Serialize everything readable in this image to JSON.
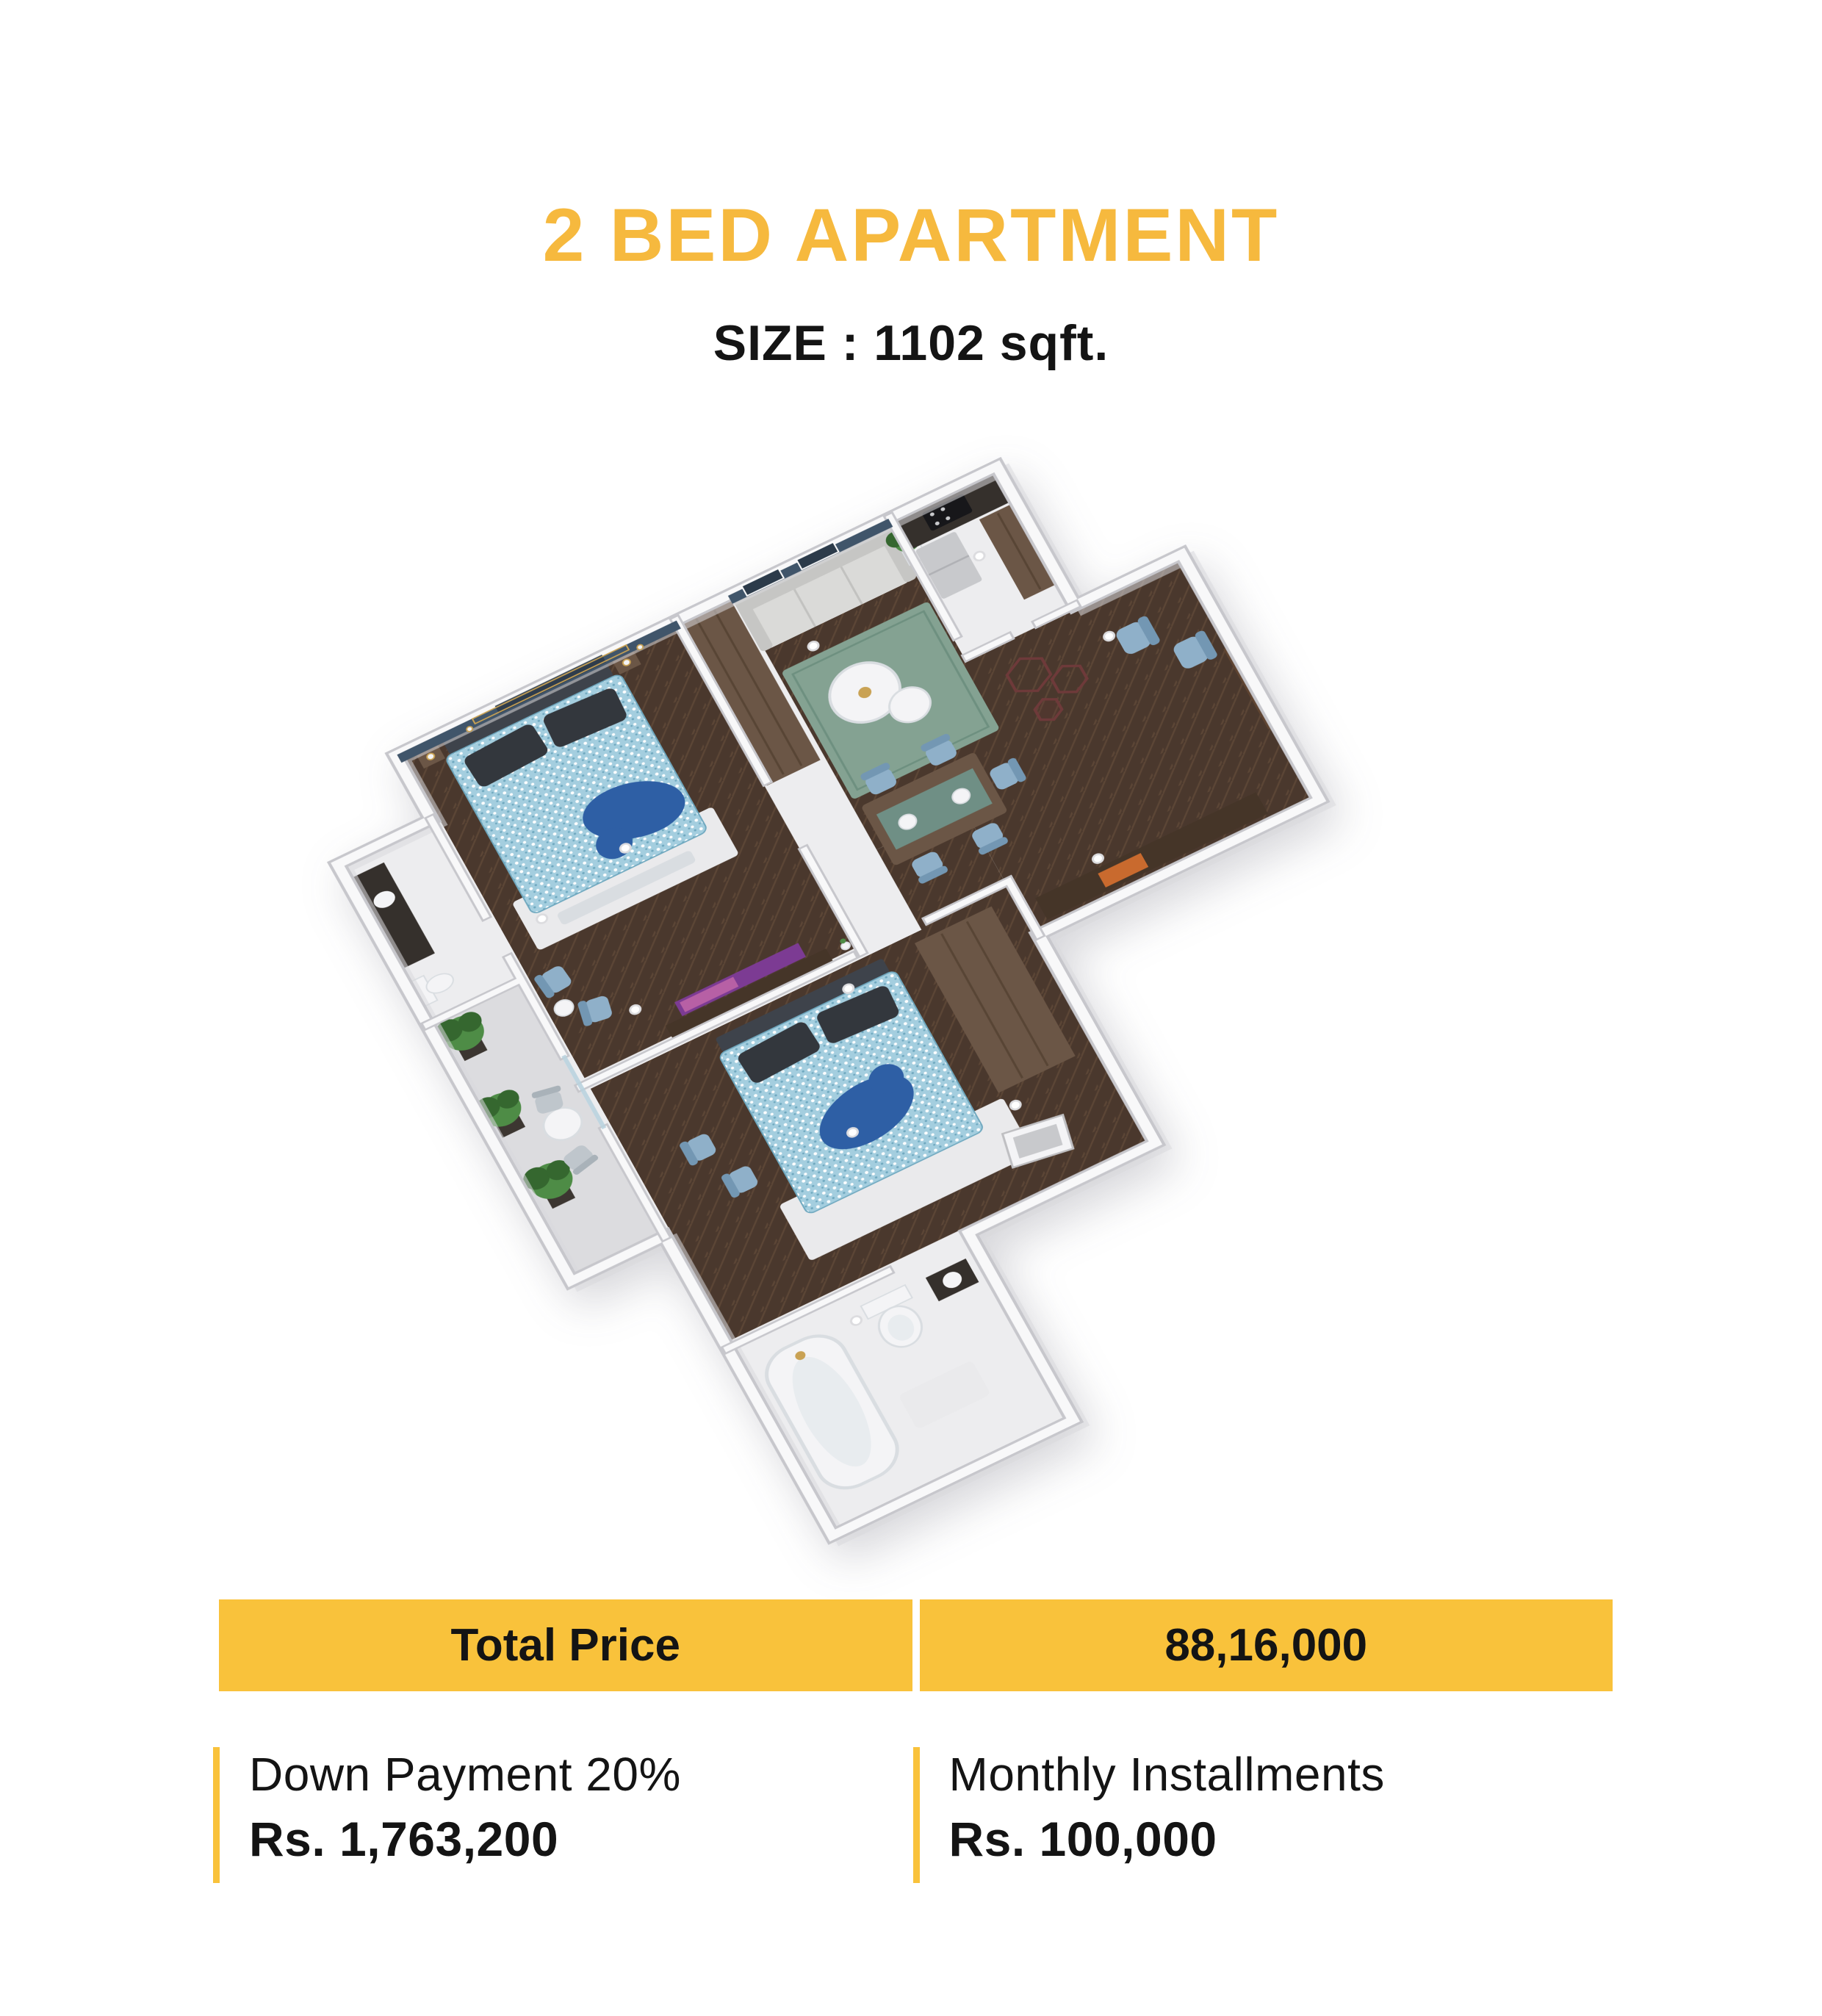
{
  "header": {
    "title": "2 BED APARTMENT",
    "size_label": "SIZE : 1102 sqft."
  },
  "pricing": {
    "total_price_label": "Total Price",
    "total_price_value": "88,16,000",
    "down_payment_label": "Down Payment 20%",
    "down_payment_value": "Rs. 1,763,200",
    "monthly_installments_label": "Monthly Installments",
    "monthly_installments_value": "Rs. 100,000"
  },
  "floor_plan": {
    "type": "3d-isometric-render",
    "depicted_rooms": [
      "master-bedroom",
      "second-bedroom",
      "living-room",
      "dining-area",
      "kitchen",
      "entry-hall",
      "attached-bathroom",
      "bathroom",
      "balcony"
    ]
  },
  "palette": {
    "title_yellow": "#F6B93E",
    "bar_yellow": "#F9C23B",
    "text_black": "#141414",
    "marble": "#EDEDEF",
    "balcony_floor": "#DCDCDF",
    "wall_white": "#F8F8F9",
    "wall_edge": "#C7C7CC",
    "wall_shadow": "#D8D8DC",
    "accent_wall_blue": "#40556A",
    "window_dark": "#2C3B4A",
    "floor_wood": "#4A382D",
    "floor_wood_line": "#5C4636",
    "rug_green": "#84A292",
    "rug_green_line": "#6E9080",
    "rug_white": "#EAEAEC",
    "bed_blue": "#A4CEDF",
    "bed_speckle_light": "#FFFFFF",
    "bed_speckle_dark": "#6FA8BF",
    "bed_throw_blue": "#2E5FA5",
    "pillow_dark": "#33373D",
    "headboard_dark": "#3E434B",
    "sofa_gray": "#DADAD8",
    "sofa_gray_dark": "#C6C6C4",
    "sofa_cushion_line": "#C2C2C0",
    "chair_blue": "#8FB0C9",
    "chair_blue_dark": "#7397B3",
    "chair_gray": "#BFC6CC",
    "chair_gray_dark": "#A9B2B9",
    "wood_brown": "#6B5646",
    "wood_brown_line": "#584535",
    "door_brown": "#5F4431",
    "counter_dark": "#35302C",
    "cooktop_black": "#17171A",
    "steel_gray": "#C8C9CC",
    "steel_line": "#B0B1B5",
    "console_dark": "#453528",
    "console_orange": "#C96A2E",
    "tv_purple": "#7C3B93",
    "tv_pink": "#C267A8",
    "plant_green": "#4E8C46",
    "plant_green_dark": "#35672F",
    "plant_pot": "#3C3631",
    "hex_art": "#6E3A3A",
    "porcelain": "#F4F4F6",
    "porcelain_shade": "#D9DDE1",
    "tub_inner": "#E8ECEF",
    "gold": "#C9A254",
    "glass_blue": "#B9D2DE",
    "table_runner": "#6F8F85"
  }
}
